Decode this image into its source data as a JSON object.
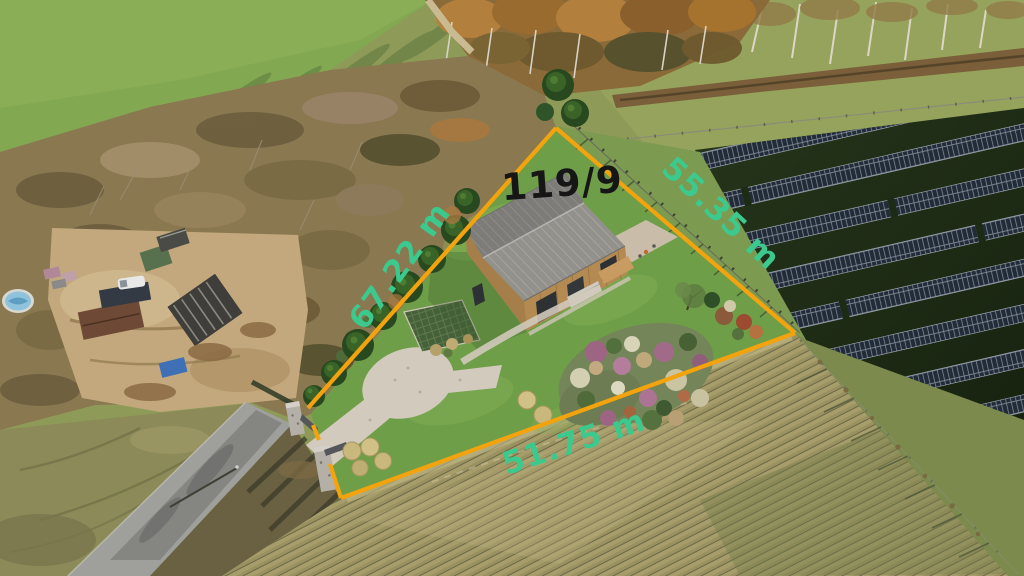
{
  "annotations": {
    "parcel_number": "119/9",
    "dimensions": {
      "left_edge": "67.22 m",
      "right_edge": "55.35 m",
      "bottom_edge": "51.75 m"
    },
    "boundary_color": "#f2a30d",
    "dimension_label_color": "#3cc98d",
    "parcel_number_color": "#161616"
  }
}
